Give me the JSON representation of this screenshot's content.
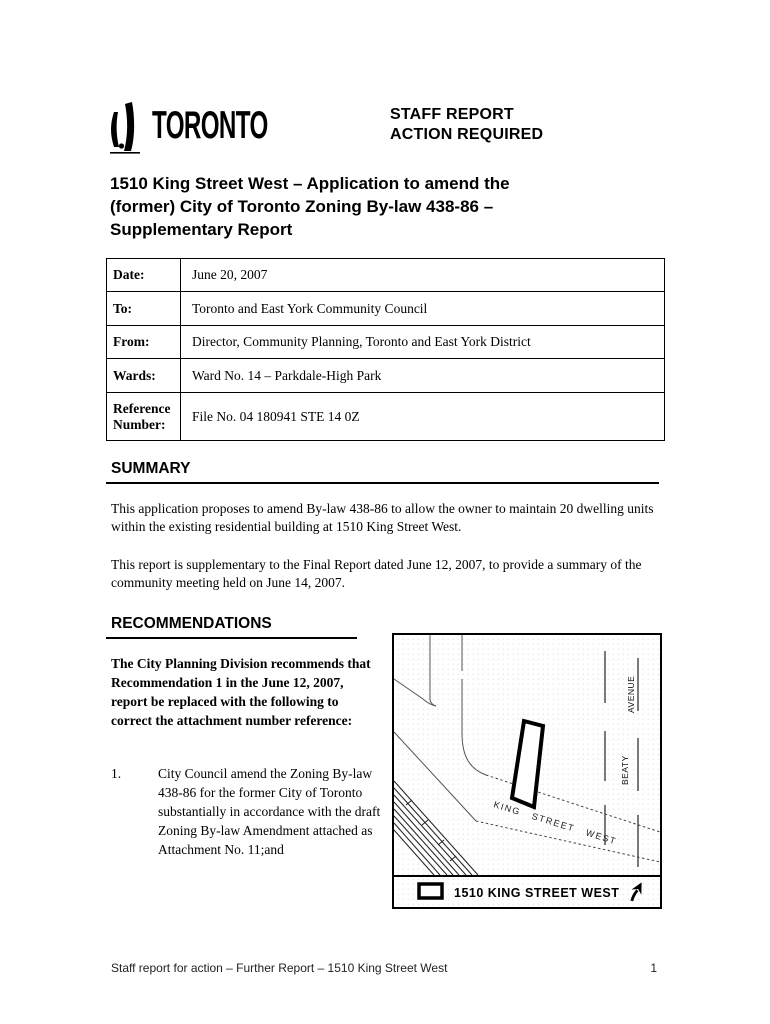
{
  "header": {
    "logo_text": "TORONTO",
    "report_type_line1": "STAFF REPORT",
    "report_type_line2": "ACTION REQUIRED"
  },
  "title": {
    "lines": [
      "1510 King Street West – Application to amend the",
      "(former) City of Toronto Zoning By-law 438-86 –",
      "Supplementary Report"
    ]
  },
  "info_table": {
    "rows": [
      {
        "label": "Date:",
        "value": "June 20, 2007"
      },
      {
        "label": "To:",
        "value": "Toronto and East York Community Council"
      },
      {
        "label": "From:",
        "value": "Director, Community Planning, Toronto and East York District"
      },
      {
        "label": "Wards:",
        "value": "Ward No. 14 – Parkdale-High Park"
      },
      {
        "label": "Reference Number:",
        "value": "File No. 04 180941 STE 14 0Z"
      }
    ]
  },
  "summary": {
    "heading": "SUMMARY",
    "paragraphs": [
      "This application proposes to amend By-law 438-86 to allow the owner to maintain 20 dwelling units within the existing residential building at 1510 King Street West.",
      "This report is supplementary to the Final Report dated June 12, 2007, to provide a summary of the community meeting held on June 14, 2007."
    ]
  },
  "recommendations": {
    "heading": "RECOMMENDATIONS",
    "intro": "The City Planning Division recommends that Recommendation 1 in the June 12, 2007, report be replaced with the following to correct the attachment number reference:",
    "items": [
      {
        "number": "1.",
        "text": "City Council amend the Zoning By-law 438-86 for the former City of Toronto substantially in accordance with the draft Zoning By-law Amendment attached as Attachment No. 11;and"
      }
    ]
  },
  "map": {
    "king_street": "KING STREET WEST",
    "beaty": "BEATY",
    "avenue": "AVENUE",
    "legend_label": "1510 KING STREET WEST"
  },
  "footer": {
    "text": "Staff report for action – Further Report – 1510 King Street West",
    "page_number": "1"
  }
}
